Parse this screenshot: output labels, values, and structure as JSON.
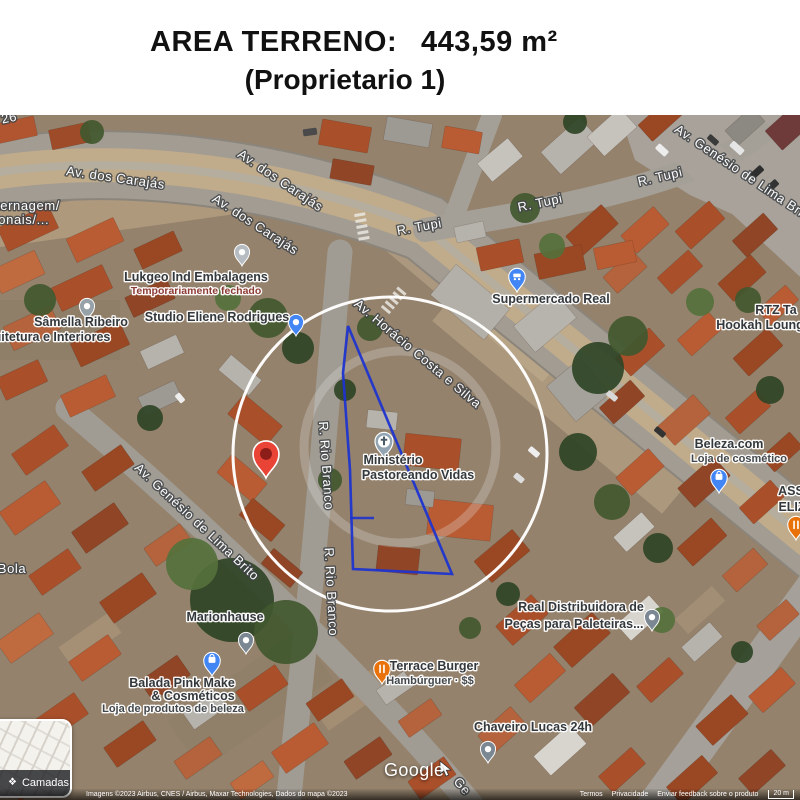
{
  "header": {
    "area_label": "AREA TERRENO:",
    "area_value": "443,59 m²",
    "owner": "(Proprietario 1)"
  },
  "map": {
    "controls": {
      "layers": "Camadas"
    },
    "watermark": "Google",
    "attribution": {
      "imagery": "Imagens ©2023 Airbus, CNES / Airbus, Maxar Technologies, Dados do mapa ©2023",
      "links": [
        "Termos",
        "Privacidade",
        "Enviar feedback sobre o produto"
      ],
      "scale": "20 m"
    },
    "street_labels": [
      {
        "t": "Av. dos Carajás",
        "x": 115,
        "y": 182,
        "r": 8
      },
      {
        "t": "Av. dos Carajás",
        "x": 278,
        "y": 184,
        "r": 34
      },
      {
        "t": "Av. dos Carajás",
        "x": 253,
        "y": 228,
        "r": 33
      },
      {
        "t": "R. Tupi",
        "x": 420,
        "y": 231,
        "r": -10
      },
      {
        "t": "R. Tupi",
        "x": 541,
        "y": 207,
        "r": -12
      },
      {
        "t": "R. Tupi",
        "x": 661,
        "y": 181,
        "r": -13
      },
      {
        "t": "Av. Genésio de Lima Bri",
        "x": 737,
        "y": 174,
        "r": 34
      },
      {
        "t": "Av. Horácio Costa e Silva",
        "x": 415,
        "y": 357,
        "r": 40
      },
      {
        "t": "R. Rio Branco",
        "x": 322,
        "y": 466,
        "r": 86
      },
      {
        "t": "R. Rio Branco",
        "x": 327,
        "y": 592,
        "r": 87
      },
      {
        "t": "Av. Genésio de Lima Brito",
        "x": 194,
        "y": 525,
        "r": 43
      },
      {
        "t": "ternagem/",
        "x": 28,
        "y": 210,
        "r": 0
      },
      {
        "t": "ionais/...",
        "x": 22,
        "y": 224,
        "r": 0
      },
      {
        "t": "Bola",
        "x": 12,
        "y": 573,
        "r": 0
      },
      {
        "t": "26",
        "x": 10,
        "y": 122,
        "r": -12
      },
      {
        "t": "Ge",
        "x": 459,
        "y": 789,
        "r": 50
      }
    ],
    "pois": [
      {
        "id": "lukgeo",
        "pin": {
          "type": "dot",
          "color": "#b6bcc1",
          "x": 242,
          "y": 266
        },
        "lines": [
          {
            "t": "Lukgeo Ind Embalagens",
            "x": 196,
            "y": 281,
            "s": 12.5,
            "c": "#33383c"
          },
          {
            "t": "Temporariamente fechado",
            "x": 196,
            "y": 294,
            "s": 10.5,
            "c": "#8d3b35"
          }
        ]
      },
      {
        "id": "studio-eliene",
        "pin": {
          "type": "dot",
          "color": "#4285f4",
          "x": 296,
          "y": 336
        },
        "lines": [
          {
            "t": "Studio Eliene Rodrigues",
            "x": 217,
            "y": 321,
            "s": 12.5,
            "c": "#33383c"
          }
        ]
      },
      {
        "id": "samella",
        "pin": {
          "type": "dot",
          "color": "#97a1a8",
          "x": 87,
          "y": 320
        },
        "lines": [
          {
            "t": "Sâmella Ribeiro",
            "x": 81,
            "y": 326,
            "s": 12.5,
            "c": "#33383c"
          },
          {
            "t": "uitetura e Interiores",
            "x": 52,
            "y": 341,
            "s": 12.5,
            "c": "#33383c"
          }
        ]
      },
      {
        "id": "supermercado-real",
        "pin": {
          "type": "cart",
          "color": "#4285f4",
          "x": 517,
          "y": 292
        },
        "lines": [
          {
            "t": "Supermercado Real",
            "x": 551,
            "y": 303,
            "s": 12.5,
            "c": "#33383c"
          }
        ]
      },
      {
        "id": "ministerio",
        "pin": {
          "type": "church",
          "color": "#93a5b2",
          "x": 384,
          "y": 458
        },
        "lines": [
          {
            "t": "Ministério",
            "x": 393,
            "y": 464,
            "s": 12.5,
            "c": "#33383c"
          },
          {
            "t": "Pastoreando Vidas",
            "x": 418,
            "y": 479,
            "s": 12.5,
            "c": "#33383c"
          }
        ]
      },
      {
        "id": "marionhause",
        "pin": {
          "type": "dot",
          "color": "#7b8893",
          "x": 246,
          "y": 654
        },
        "lines": [
          {
            "t": "Marionhause",
            "x": 225,
            "y": 621,
            "s": 12.5,
            "c": "#33383c"
          }
        ]
      },
      {
        "id": "balada-pink",
        "pin": {
          "type": "bag",
          "color": "#4285f4",
          "x": 212,
          "y": 676
        },
        "lines": [
          {
            "t": "Balada Pink Make",
            "x": 182,
            "y": 687,
            "s": 12.5,
            "c": "#33383c"
          },
          {
            "t": "& Cosméticos",
            "x": 193,
            "y": 700,
            "s": 12.5,
            "c": "#33383c"
          },
          {
            "t": "Loja de produtos de beleza",
            "x": 173,
            "y": 712,
            "s": 11,
            "c": "#43484c"
          }
        ]
      },
      {
        "id": "terrace-burger",
        "pin": {
          "type": "food",
          "color": "#e8710a",
          "x": 382,
          "y": 684
        },
        "lines": [
          {
            "t": "Terrace Burger",
            "x": 434,
            "y": 670,
            "s": 12.5,
            "c": "#33383c"
          },
          {
            "t": "Hambúrguer · $$",
            "x": 430,
            "y": 684,
            "s": 11,
            "c": "#43484c"
          }
        ]
      },
      {
        "id": "chaveiro-lucas",
        "pin": {
          "type": "dot",
          "color": "#7b8893",
          "x": 488,
          "y": 763
        },
        "lines": [
          {
            "t": "Chaveiro Lucas 24h",
            "x": 533,
            "y": 731,
            "s": 12.5,
            "c": "#33383c"
          }
        ]
      },
      {
        "id": "real-distribuidora",
        "pin": {
          "type": "dot",
          "color": "#7b8893",
          "x": 652,
          "y": 631
        },
        "lines": [
          {
            "t": "Real Distribuidora de",
            "x": 581,
            "y": 611,
            "s": 12.5,
            "c": "#33383c"
          },
          {
            "t": "Peças para Paleteiras...",
            "x": 574,
            "y": 628,
            "s": 12.5,
            "c": "#33383c"
          }
        ]
      },
      {
        "id": "beleza-com",
        "pin": {
          "type": "bag",
          "color": "#4285f4",
          "x": 719,
          "y": 493
        },
        "lines": [
          {
            "t": "Beleza.com",
            "x": 729,
            "y": 448,
            "s": 12.5,
            "c": "#33383c"
          },
          {
            "t": "Loja de cosmético",
            "x": 739,
            "y": 462,
            "s": 11,
            "c": "#43484c"
          }
        ]
      },
      {
        "id": "rtz-hookah",
        "pin": null,
        "lines": [
          {
            "t": "RTZ Ta",
            "x": 776,
            "y": 314,
            "s": 12.5,
            "c": "#33383c"
          },
          {
            "t": "Hookah Loung",
            "x": 760,
            "y": 329,
            "s": 12.5,
            "c": "#33383c"
          }
        ]
      },
      {
        "id": "ass-eliz",
        "pin": {
          "type": "food",
          "color": "#e8710a",
          "x": 796,
          "y": 540
        },
        "lines": [
          {
            "t": "ASS",
            "x": 791,
            "y": 495,
            "s": 12.5,
            "c": "#33383c"
          },
          {
            "t": "ELIZ",
            "x": 792,
            "y": 511,
            "s": 12.5,
            "c": "#33383c"
          }
        ]
      }
    ],
    "overlay": {
      "circle": {
        "cx": 390,
        "cy": 454,
        "r": 157,
        "color": "#ffffff"
      },
      "inner_ring": {
        "cx": 400,
        "cy": 447,
        "r": 96,
        "color": "#e3e3e3"
      },
      "polygon": {
        "color": "#1e34cf",
        "points": [
          [
            348,
            326
          ],
          [
            343,
            373
          ],
          [
            350,
            470
          ],
          [
            353,
            569
          ],
          [
            452,
            574
          ]
        ],
        "segment": [
          [
            350,
            518
          ],
          [
            374,
            518
          ]
        ]
      },
      "marker": {
        "x": 266,
        "y": 478,
        "color": "#e94436"
      }
    }
  }
}
